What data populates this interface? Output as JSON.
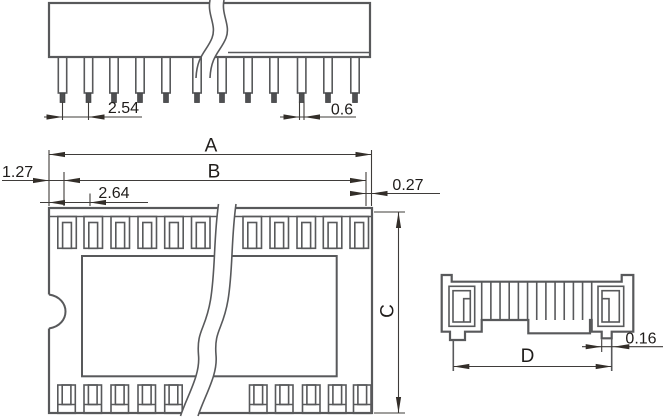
{
  "diagram": {
    "title": "DIP socket dimensional drawing (three views)",
    "colors": {
      "outline": "#58595b",
      "dimension_line": "#3f3c3a",
      "arrow": "#332e29",
      "text": "#1f1c1a",
      "pin_tip_fill": "#4f5052",
      "background": "#ffffff"
    },
    "side_view": {
      "dims": {
        "pin_pitch": "2.54",
        "pin_tip_width": "0.6"
      }
    },
    "top_view": {
      "dims": {
        "overall_length": "A",
        "contact_row_span": "B",
        "body_width": "C",
        "left_end_offset": "1.27",
        "first_contact_offset": "2.64",
        "right_end_offset": "0.27"
      }
    },
    "end_view": {
      "dims": {
        "pin_row_spacing": "D",
        "pin_thickness": "0.16"
      }
    }
  }
}
